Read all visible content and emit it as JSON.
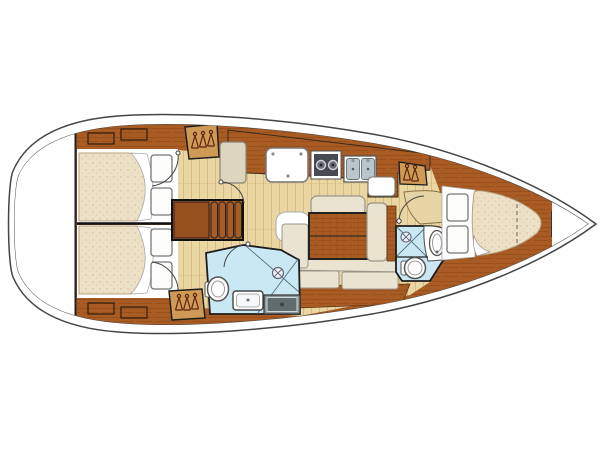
{
  "meta": {
    "description": "Top-down interior floor plan diagram of a sailing yacht, bow pointing right, no visible text",
    "diagram_type": "yacht-deck-plan",
    "orientation": "bow-right",
    "visible_text": []
  },
  "palette": {
    "outline": "#454545",
    "background": "#ffffff",
    "wood": "#a85c24",
    "wood_grain": "#8a4818",
    "wood_dark": "#6e3a12",
    "wardrobe": "#cf9a55",
    "hanger": "#5e2410",
    "floor": "#e9d6a2",
    "floor_line": "#d5bd82",
    "mattress": "#ece0c6",
    "mattress_dot": "#d9c7a4",
    "cushion": "#e9e3d0",
    "cushion_border": "#9a9488",
    "head_floor": "#c9e8f4",
    "head_outline": "#1c1c1c",
    "fixture_border": "#555555",
    "steel": "#b9c6cc",
    "stove": "#474a52",
    "pan": "#8a9698",
    "pan_dark": "#5f6b6d",
    "white": "#ffffff"
  },
  "rooms": [
    {
      "id": "aft-cabin-port",
      "fixtures": [
        "double-berth",
        "pillows",
        "lockers",
        "hanging-locker",
        "door"
      ]
    },
    {
      "id": "aft-cabin-starboard",
      "fixtures": [
        "double-berth",
        "pillows",
        "lockers",
        "hanging-locker",
        "door"
      ]
    },
    {
      "id": "galley",
      "fixtures": [
        "counter",
        "icebox-lid",
        "two-burner-stove",
        "double-sink",
        "fridge-top",
        "cabinet"
      ]
    },
    {
      "id": "companionway",
      "fixtures": [
        "stairs-four-steps"
      ]
    },
    {
      "id": "salon",
      "fixtures": [
        "table",
        "u-settee",
        "bench-settee",
        "backrest-cushion"
      ]
    },
    {
      "id": "aft-head",
      "fixtures": [
        "toilet",
        "sink",
        "shower-drain",
        "shower-pan"
      ]
    },
    {
      "id": "forward-head",
      "fixtures": [
        "toilet",
        "oval-sink",
        "shower-drain",
        "vanity-counter"
      ]
    },
    {
      "id": "forward-cabin",
      "fixtures": [
        "v-berth",
        "pillows",
        "hanging-locker",
        "dressing-seat",
        "door"
      ]
    }
  ]
}
